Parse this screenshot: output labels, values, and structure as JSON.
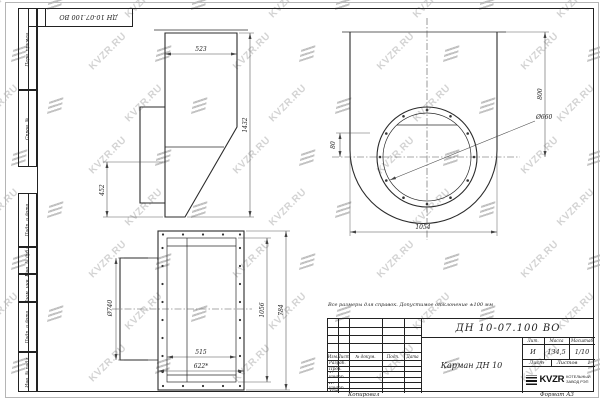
{
  "watermark": {
    "text": "KVZR.RU"
  },
  "margin_labels": [
    "Перв. примен.",
    "Справ. №",
    "Подп. и дата",
    "Инв. № дубл.",
    "Взам. инв. №",
    "Подп. и дата",
    "Инв. № подл."
  ],
  "note": "Все размеры для справок. Допустимое отклонение  ±100 мм",
  "views": {
    "side": {
      "top_width": "523",
      "height": "1432",
      "flange_height": "452"
    },
    "front": {
      "height": "800",
      "bottom_width": "1054",
      "flange_diameter": "Ø660",
      "offset": "80"
    },
    "back": {
      "inner_width": "515",
      "outer_width": "622*",
      "inner_height": "1056",
      "outer_height": "784",
      "stub_diameter": "Ø740"
    }
  },
  "title_block": {
    "designation": "ДН 10-07.100  ВО",
    "part_name": "Карман ДН 10",
    "header_cols": [
      "Изм.",
      "Лист",
      "№ докум.",
      "Подп.",
      "Дата"
    ],
    "sign_rows": [
      "Разраб.",
      "Пров.",
      "Т. контр.",
      "Н. контр.",
      "Утв."
    ],
    "lit_label": "Лит.",
    "lit_value": "И",
    "mass_label": "Масса",
    "mass_value": "134,5",
    "scale_label": "Масштаб",
    "scale_value": "1/10",
    "sheet_label": "Лист",
    "sheets_label": "Листов",
    "sheets_value": "1",
    "company_logo": "KVZR",
    "company_name_line1": "КОТЕЛЬНЫЙ",
    "company_name_line2": "ЗАВОД РЭП",
    "copied_label": "Копировал",
    "format_label": "Формат А3"
  }
}
